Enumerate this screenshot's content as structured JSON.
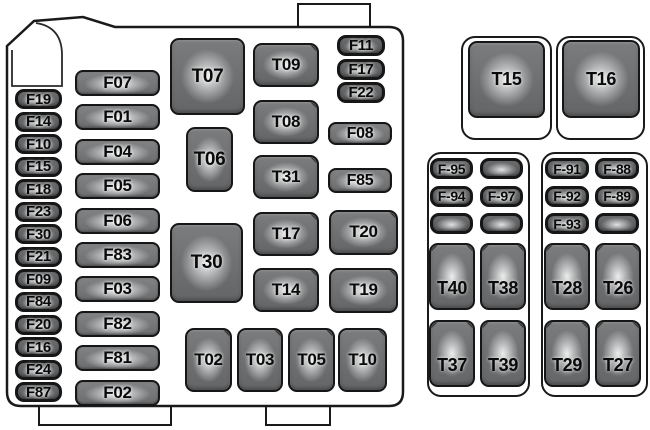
{
  "diagram": {
    "title": "engine-compartment-fuse-box-diagram",
    "colors": {
      "outline": "#1a1a1a",
      "component_body": "#6b6d6f",
      "background": "#ffffff",
      "label_text": "#0a0a0a"
    },
    "main_box": {
      "left_column_fuses": [
        "F19",
        "F14",
        "F10",
        "F15",
        "F18",
        "F23",
        "F30",
        "F21",
        "F09",
        "F84",
        "F20",
        "F16",
        "F24",
        "F87"
      ],
      "second_column_fuses": [
        "F07",
        "F01",
        "F04",
        "F05",
        "F06",
        "F83",
        "F03",
        "F82",
        "F81",
        "F02"
      ],
      "small_right_fuses": [
        "F11",
        "F17",
        "F22"
      ],
      "mid_right_fuses": [
        "F08",
        "F85"
      ],
      "large_relays": [
        "T07",
        "T06",
        "T30"
      ],
      "mid_relays": [
        "T09",
        "T08",
        "T31",
        "T17",
        "T14"
      ],
      "right_relays": [
        "T20",
        "T19"
      ],
      "bottom_relays": [
        "T02",
        "T03",
        "T05",
        "T10"
      ]
    },
    "aux_panel": {
      "top_relays": [
        "T15",
        "T16"
      ],
      "left_block": {
        "fuses": [
          "F-95",
          "",
          "F-94",
          "F-97",
          "",
          ""
        ],
        "relays": [
          "T40",
          "T38",
          "T37",
          "T39"
        ]
      },
      "right_block": {
        "fuses": [
          "F-91",
          "F-88",
          "F-92",
          "F-89",
          "F-93",
          ""
        ],
        "relays": [
          "T28",
          "T26",
          "T29",
          "T27"
        ]
      }
    }
  }
}
